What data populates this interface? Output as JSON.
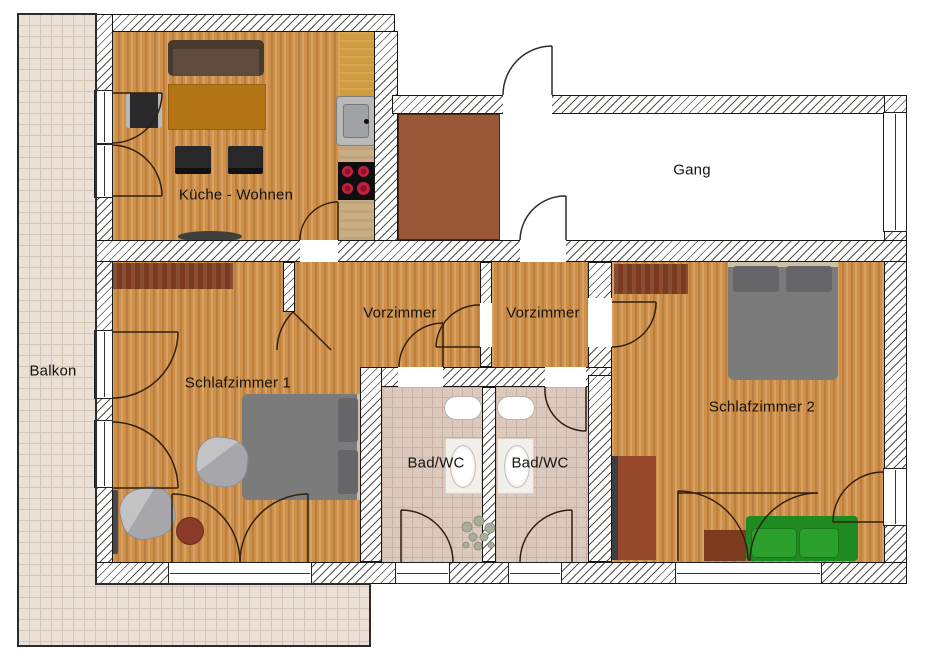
{
  "title": "Apartment floor plan",
  "rooms": {
    "kueche": {
      "label": "Küche - Wohnen"
    },
    "gang": {
      "label": "Gang"
    },
    "vorzimmer1": {
      "label": "Vorzimmer"
    },
    "vorzimmer2": {
      "label": "Vorzimmer"
    },
    "schlafzimmer1": {
      "label": "Schlafzimmer 1"
    },
    "schlafzimmer2": {
      "label": "Schlafzimmer 2"
    },
    "bad1": {
      "label": "Bad/WC"
    },
    "bad2": {
      "label": "Bad/WC"
    },
    "balkon": {
      "label": "Balkon"
    }
  },
  "palette": {
    "wood_floor": "#CE9049",
    "wall_fill": "#FFFFFF",
    "wall_hatch_line": "#56514B",
    "outline": "#161616",
    "bath_tile": "#DBC9BD",
    "balcony_tile": "#EAE0D6",
    "storage_brown": "#9A5738",
    "counter_tan": "#C9AE85",
    "counter_amber": "#D09A3E",
    "stove_red": "#C21F3C",
    "sofa_brown": "#554639",
    "sofa_green": "#2CA02C",
    "bed_gray": "#7B7B7B",
    "pillow_gray": "#66666A",
    "headboard_beige": "#CBC1A8",
    "wardrobe_brown": "#7B3A1E",
    "door_arc": "#32200F"
  }
}
